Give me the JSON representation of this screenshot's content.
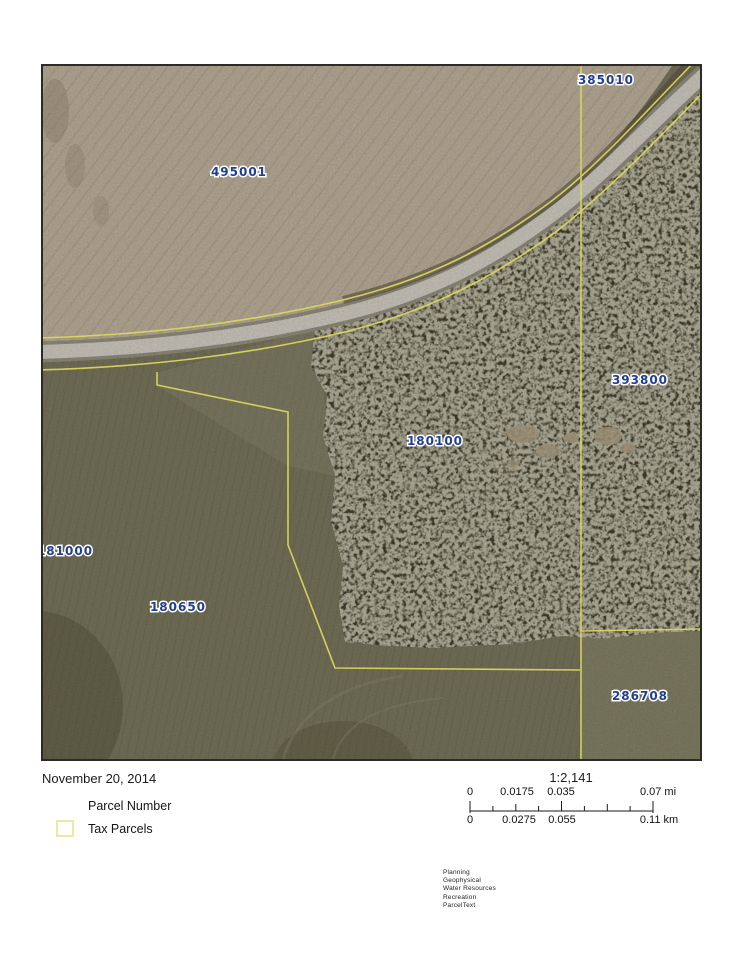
{
  "map": {
    "date": "November 20, 2014",
    "scale_ratio": "1:2,141",
    "parcel_labels": [
      {
        "text": "385010",
        "x": 563,
        "y": 18
      },
      {
        "text": "495001",
        "x": 196,
        "y": 110
      },
      {
        "text": "393800",
        "x": 597,
        "y": 318
      },
      {
        "text": "180100",
        "x": 392,
        "y": 379
      },
      {
        "text": "181000",
        "x": 22,
        "y": 489
      },
      {
        "text": "180650",
        "x": 135,
        "y": 545
      },
      {
        "text": "286708",
        "x": 597,
        "y": 634
      }
    ],
    "legend": {
      "items": [
        {
          "label": "Parcel Number"
        },
        {
          "label": "Tax Parcels"
        }
      ]
    },
    "scalebar": {
      "mi": {
        "labels": [
          "0",
          "0.0175",
          "0.035",
          "0.07 mi"
        ]
      },
      "km": {
        "labels": [
          "0",
          "0.0275",
          "0.055",
          "0.11 km"
        ]
      }
    },
    "credits": [
      "Planning",
      "Geophysical",
      "Water Resources",
      "Recreation",
      "ParcelText"
    ],
    "colors": {
      "parcel_line": "#dcd95c",
      "label_text": "#223f8e",
      "swatch_border": "#e9e9ac",
      "road": "#cac6bc",
      "forest": "#403d2c",
      "field_tan": "#b7ab97",
      "field_olive": "#75725a"
    }
  }
}
